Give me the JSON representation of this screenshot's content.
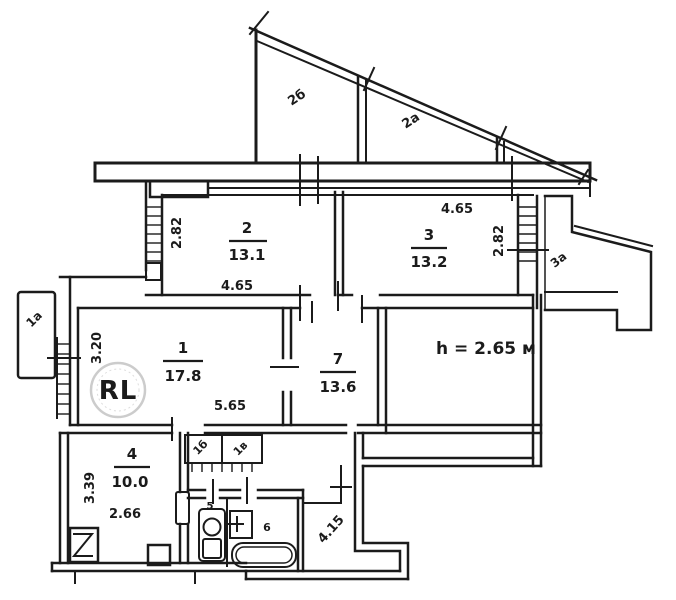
{
  "plan": {
    "height_note": "h = 2.65 м",
    "watermark": "RL",
    "rooms": {
      "attic_left": {
        "label": "2б"
      },
      "attic_right": {
        "label": "2а"
      },
      "r2": {
        "number": "2",
        "area": "13.1"
      },
      "r3": {
        "number": "3",
        "area": "13.2"
      },
      "r1": {
        "number": "1",
        "area": "17.8"
      },
      "r7": {
        "number": "7",
        "area": "13.6"
      },
      "r4": {
        "number": "4",
        "area": "10.0"
      },
      "wc": {
        "number": "5"
      },
      "bath": {
        "number": "6"
      }
    },
    "annexes": {
      "balcony_left": {
        "label": "1а"
      },
      "balcony_right": {
        "label": "3а"
      },
      "closet_left": {
        "label": "1б"
      },
      "closet_right": {
        "label": "1в"
      }
    },
    "dimensions": {
      "r2_width": "4.65",
      "r2_depth": "2.82",
      "r3_width": "4.65",
      "r3_depth": "2.82",
      "r1_width": "5.65",
      "r1_depth": "3.20",
      "r4_width": "2.66",
      "r4_depth": "3.39",
      "hall": "4.15"
    },
    "colors": {
      "ink": "#1b1b1b",
      "logo_gold": "#b08d2a",
      "logo_ring": "#cccccc"
    }
  }
}
